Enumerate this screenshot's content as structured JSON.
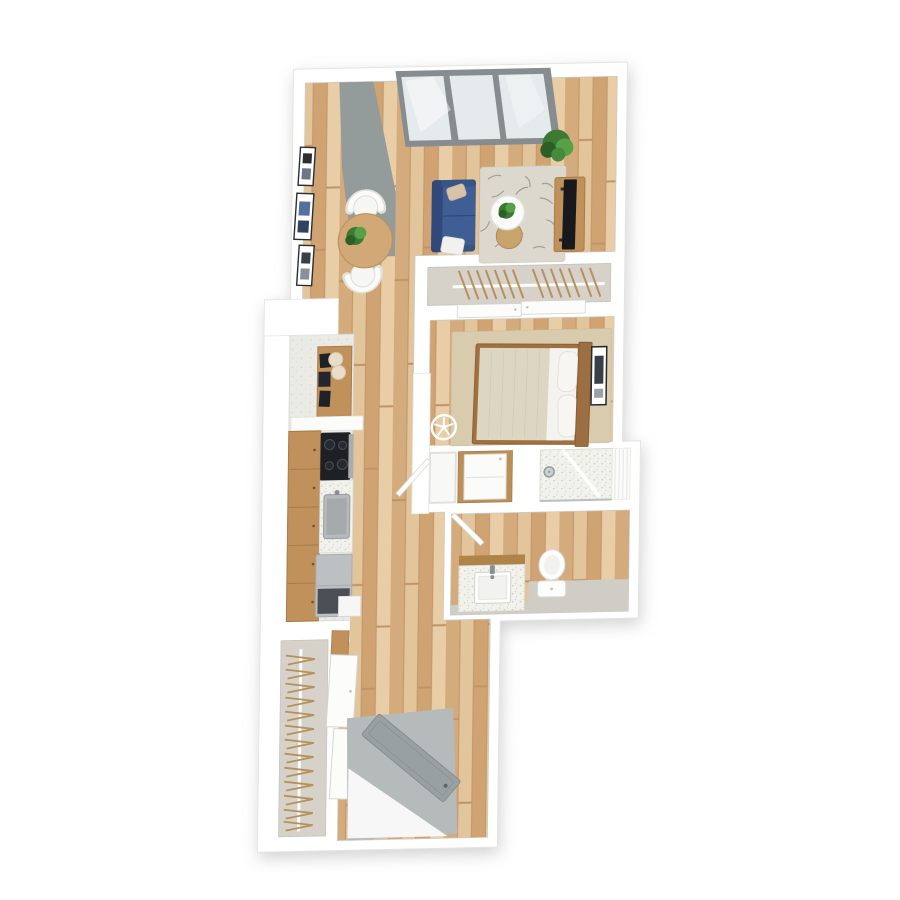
{
  "scene": {
    "kind": "3d-floor-plan-render",
    "view": "top-down-perspective",
    "background": "#ffffff"
  },
  "palette": {
    "wall_white": "#ffffff",
    "wall_edge": "#e2e2df",
    "wood_floor": "#dcba90",
    "kitchen_floor": "#eaebe5",
    "closet_floor": "#d6d2ca",
    "column_gray": "#939c9a",
    "glass": "#e5eaec",
    "window_frame": "#868c8f",
    "sofa_blue": "#3f5f94",
    "sofa_blue_dark": "#30497a",
    "pillow_beige": "#d8c3a8",
    "throw_white": "#f2f1ed",
    "living_rug": "#dcd8ce",
    "rug_feather": "#8f8c84",
    "dining_table_wood": "#d2a876",
    "chair_white": "#f6f6f3",
    "cabinet_wood": "#c0915a",
    "tv_black": "#17191d",
    "plant_green": "#3c7a33",
    "plant_green_light": "#57a047",
    "pot_white": "#eff0ee",
    "mattress_linen": "#ddd6c3",
    "sheet_white": "#f4f3ef",
    "bed_frame_wood": "#9c6f42",
    "bedroom_rug": "#d8cbae",
    "hanger_wood": "#b8905a",
    "rod_white": "#fcfcfb",
    "fridge_gray": "#bcc0c2",
    "cooktop_black": "#1d2025",
    "sink_steel": "#b6babc",
    "counter_speckle": "#f1f2ec",
    "vanity_wood": "#b08449",
    "fixture_white": "#fdfdfc",
    "bath_gray_floor": "#d0cdc7",
    "tile_white": "#fbfbfa",
    "entry_mat": "#b5babb",
    "entry_door": "#99a0a2",
    "door_white": "#fcfcfb",
    "art_frame": "#2b2e33",
    "art_blue": "#53719f"
  },
  "rooms": [
    {
      "id": "living-room",
      "floor": "wood"
    },
    {
      "id": "dining-nook",
      "floor": "wood"
    },
    {
      "id": "kitchen",
      "floor": "light-tile"
    },
    {
      "id": "hallway",
      "floor": "wood"
    },
    {
      "id": "bedroom",
      "floor": "wood"
    },
    {
      "id": "bedroom-closet",
      "floor": "gray"
    },
    {
      "id": "walk-in-closet",
      "floor": "gray"
    },
    {
      "id": "laundry-closet",
      "floor": "white"
    },
    {
      "id": "shower",
      "floor": "speckled-tile"
    },
    {
      "id": "bathroom",
      "floor": "wood-and-gray"
    },
    {
      "id": "entry",
      "floor": "gray-mat"
    }
  ],
  "furniture": {
    "living_room": [
      "skylight-window",
      "gray-column",
      "wall-art-x3",
      "dining-table",
      "dining-chairs-x2",
      "table-plant",
      "sofa",
      "accent-pillow",
      "white-throw",
      "area-rug",
      "coffee-table",
      "nesting-side-table",
      "coffee-table-plant",
      "media-console",
      "tv",
      "corner-plant"
    ],
    "bedroom": [
      "bed",
      "pillows-x2",
      "headboard",
      "area-rug",
      "wall-art",
      "ceiling-fan-symbol",
      "closet-rod-with-hangers",
      "sliding-closet-doors"
    ],
    "kitchen": [
      "sideboard-with-frames",
      "counter-stools-x2",
      "white-counter",
      "base-cabinets",
      "cooktop",
      "prep-counter",
      "sink",
      "refrigerator"
    ],
    "bathroom": [
      "vanity-with-sink",
      "faucet",
      "toilet",
      "shower-drain",
      "shower-glass",
      "tile-wall",
      "laundry-unit",
      "linen-closet-door",
      "open-door"
    ],
    "entry": [
      "door-mat",
      "open-entry-door",
      "door-swing"
    ],
    "walk_in_closet": [
      "closet-rod-with-hangers",
      "sliding-doors",
      "wood-shelf"
    ]
  }
}
